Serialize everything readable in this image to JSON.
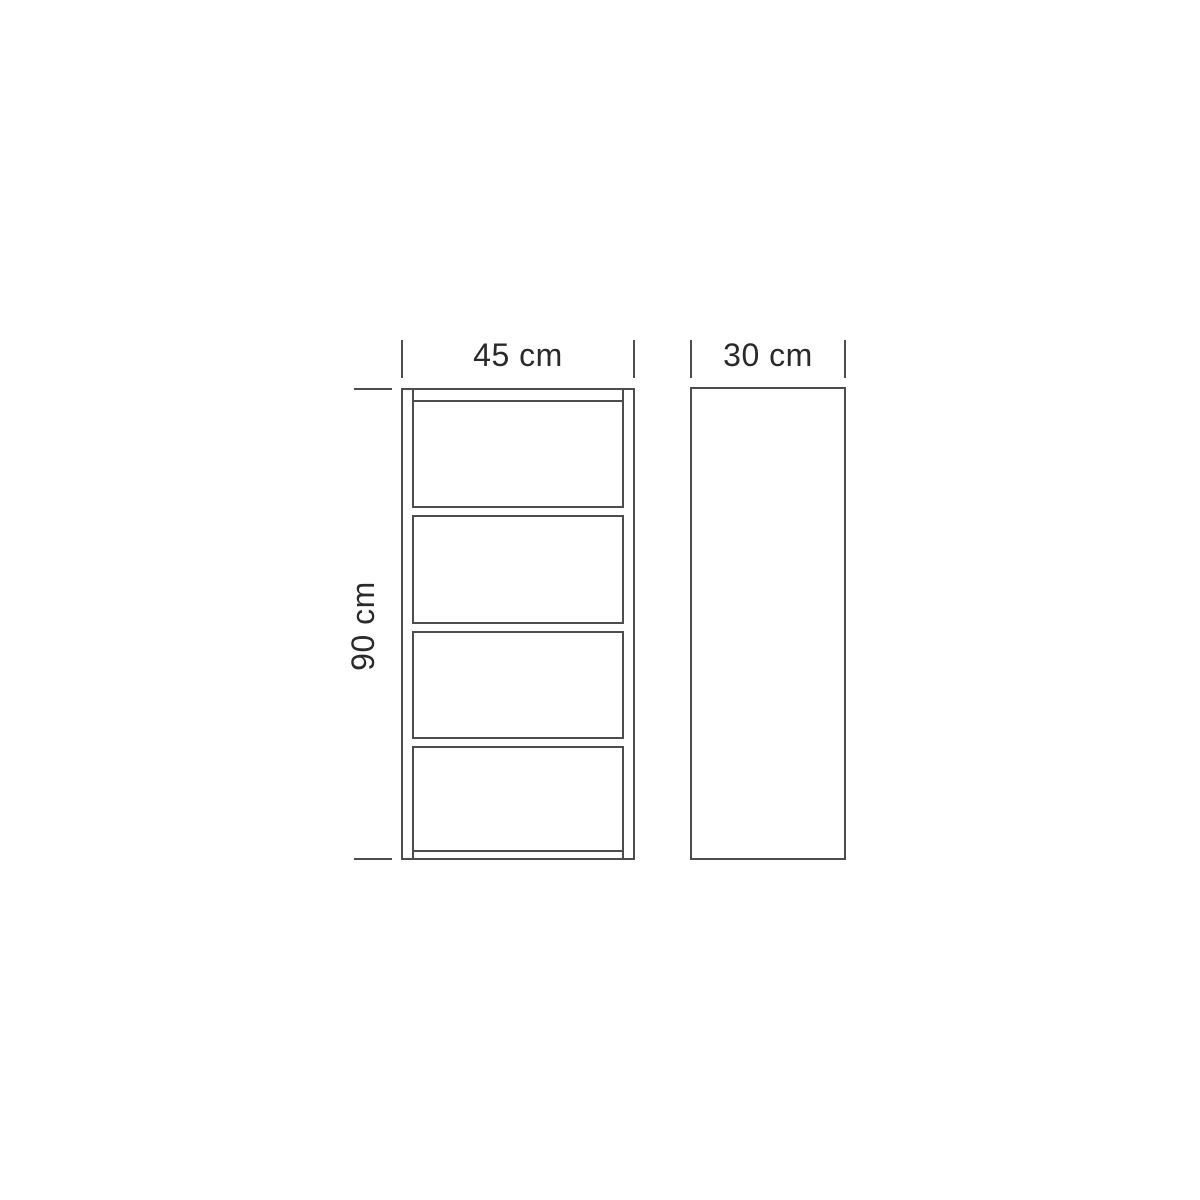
{
  "page": {
    "background": "#ffffff"
  },
  "diagram": {
    "type": "furniture-dimension-drawing",
    "subject": "shelf unit, front elevation and side profile",
    "colors": {
      "line": "#4d4d4d",
      "text": "#2a2a2a"
    },
    "front_view": {
      "width_label": "45 cm",
      "width_cm": 45,
      "height_label": "90 cm",
      "height_cm": 90,
      "shelf_count": 3,
      "compartment_count": 4
    },
    "side_view": {
      "depth_label": "30 cm",
      "depth_cm": 30
    }
  }
}
